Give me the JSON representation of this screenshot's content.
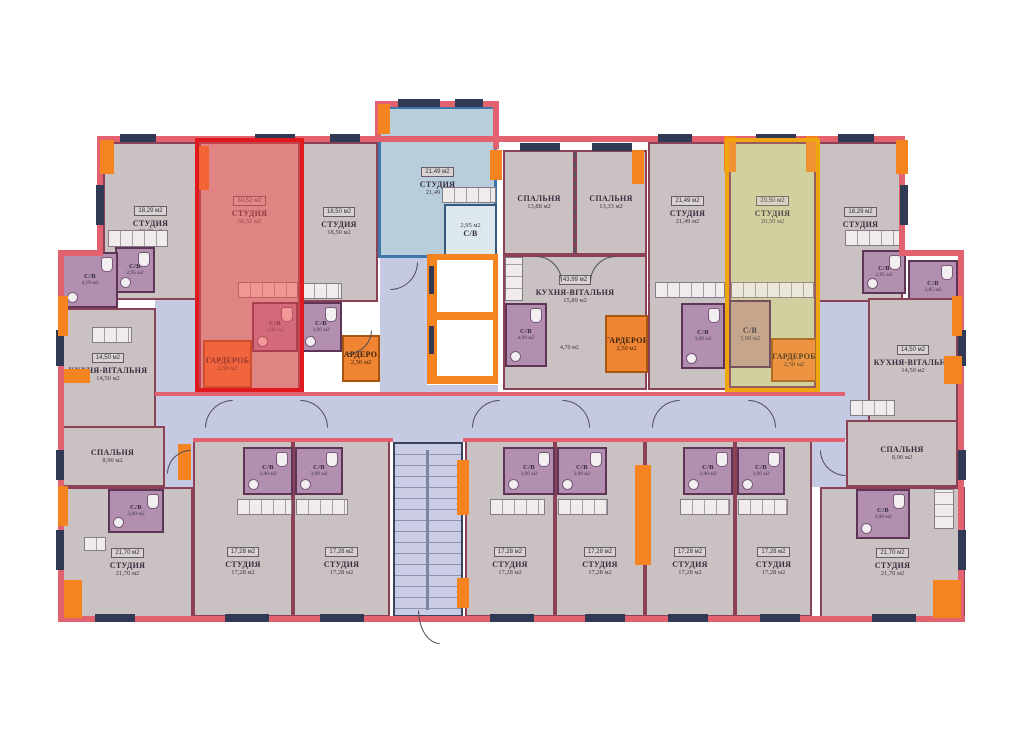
{
  "title": "Поверховий план — план квартир",
  "colors": {
    "highlight_red": "#e0191f",
    "highlight_blue": "#3f77a9",
    "highlight_yellow": "#efa50f",
    "wardrobe_orange": "#ef8532",
    "corridor": "#c6c9e2",
    "room_fill": "#cac2c2",
    "bath_fill": "#b28fae",
    "wall_pink": "#e2636f",
    "wall_navy": "#303a54",
    "wall_orange": "#f5831f"
  },
  "extra": {
    "hall_area": "4,70 м2"
  },
  "rooms": [
    {
      "id": "studio-top-1",
      "label": "СТУДИЯ",
      "area": "18,29 м2",
      "badge": "18,29 м2"
    },
    {
      "id": "wc-top-1",
      "label": "С/В",
      "area": "2,95 м2"
    },
    {
      "id": "studio-red",
      "label": "СТУДИЯ",
      "area": "30,52 м2",
      "badge": "30,52 м2"
    },
    {
      "id": "wc-red",
      "label": "С/В",
      "area": "3,00 м2"
    },
    {
      "id": "wardrobe-red",
      "label": "ГАРДЕРОБ",
      "area": "2,50 м2"
    },
    {
      "id": "studio-top-2",
      "label": "СТУДИЯ",
      "area": "18,50 м2",
      "badge": "18,50 м2"
    },
    {
      "id": "wc-top-2",
      "label": "С/В",
      "area": "3,00 м2"
    },
    {
      "id": "wardrobe-top-2",
      "label": "ГАРДЕРОБ",
      "area": "2,50 м2"
    },
    {
      "id": "studio-blue",
      "label": "СТУДИЯ",
      "area": "21,49 м2",
      "badge": "21,49 м2"
    },
    {
      "id": "wc-blue",
      "label": "С/В",
      "area": "2,95 м2"
    },
    {
      "id": "bedroom-center-1",
      "label": "СПАЛЬНЯ",
      "area": "13,88 м2"
    },
    {
      "id": "bedroom-center-2",
      "label": "СПАЛЬНЯ",
      "area": "13,33 м2"
    },
    {
      "id": "kitchen-center",
      "label": "КУХНЯ-ВІТАЛЬНЯ",
      "area": "15,89 м2",
      "badge": "43,99 м2"
    },
    {
      "id": "wc-center",
      "label": "С/В",
      "area": "4,99 м2"
    },
    {
      "id": "wardrobe-center",
      "label": "ГАРДЕРОБ",
      "area": "2,50 м2"
    },
    {
      "id": "studio-top-3",
      "label": "СТУДИЯ",
      "area": "21,49 м2",
      "badge": "21,49 м2"
    },
    {
      "id": "wc-top-3",
      "label": "С/В",
      "area": "3,00 м2"
    },
    {
      "id": "studio-yellow",
      "label": "СТУДИЯ",
      "area": "20,50 м2",
      "badge": "20,50 м2"
    },
    {
      "id": "wc-yellow",
      "label": "С/В",
      "area": "3,00 м2"
    },
    {
      "id": "wardrobe-yellow",
      "label": "ГАРДЕРОБ",
      "area": "2,50 м2"
    },
    {
      "id": "studio-top-4",
      "label": "СТУДИЯ",
      "area": "18,29 м2",
      "badge": "18,29 м2"
    },
    {
      "id": "wc-top-4",
      "label": "С/В",
      "area": "2,95 м2"
    },
    {
      "id": "wc-right",
      "label": "С/В",
      "area": "3,85 м2"
    },
    {
      "id": "kitchen-right",
      "label": "КУХНЯ-ВІТАЛЬНЯ",
      "area": "14,50 м2",
      "badge": "14,50 м2"
    },
    {
      "id": "bedroom-right",
      "label": "СПАЛЬНЯ",
      "area": "8,90 м2"
    },
    {
      "id": "wc-left",
      "label": "С/В",
      "area": "4,19 м2"
    },
    {
      "id": "kitchen-left",
      "label": "КУХНЯ-ВІТАЛЬНЯ",
      "area": "14,50 м2",
      "badge": "14,50 м2"
    },
    {
      "id": "bedroom-left",
      "label": "СПАЛЬНЯ",
      "area": "8,90 м2"
    },
    {
      "id": "studio-bottom-left",
      "label": "СТУДИЯ",
      "area": "21,70 м2",
      "badge": "21,70 м2"
    },
    {
      "id": "wc-bottom-left",
      "label": "С/В",
      "area": "3,00 м2"
    },
    {
      "id": "studio-bottom-1",
      "label": "СТУДИЯ",
      "area": "17,28 м2",
      "badge": "17,28 м2"
    },
    {
      "id": "wc-bottom-1",
      "label": "С/В",
      "area": "3,00 м2"
    },
    {
      "id": "studio-bottom-2",
      "label": "СТУДИЯ",
      "area": "17,28 м2",
      "badge": "17,28 м2"
    },
    {
      "id": "wc-bottom-2",
      "label": "С/В",
      "area": "3,00 м2"
    },
    {
      "id": "studio-bottom-3",
      "label": "СТУДИЯ",
      "area": "17,28 м2",
      "badge": "17,28 м2"
    },
    {
      "id": "wc-bottom-3",
      "label": "С/В",
      "area": "3,00 м2"
    },
    {
      "id": "studio-bottom-4",
      "label": "СТУДИЯ",
      "area": "17,28 м2",
      "badge": "17,28 м2"
    },
    {
      "id": "wc-bottom-4",
      "label": "С/В",
      "area": "3,00 м2"
    },
    {
      "id": "studio-bottom-5",
      "label": "СТУДИЯ",
      "area": "17,28 м2",
      "badge": "17,28 м2"
    },
    {
      "id": "wc-bottom-5",
      "label": "С/В",
      "area": "3,00 м2"
    },
    {
      "id": "studio-bottom-6",
      "label": "СТУДИЯ",
      "area": "17,28 м2",
      "badge": "17,28 м2"
    },
    {
      "id": "wc-bottom-6",
      "label": "С/В",
      "area": "3,00 м2"
    },
    {
      "id": "studio-bottom-right",
      "label": "СТУДИЯ",
      "area": "21,70 м2",
      "badge": "21,70 м2"
    },
    {
      "id": "wc-bottom-right",
      "label": "С/В",
      "area": "3,00 м2"
    }
  ]
}
